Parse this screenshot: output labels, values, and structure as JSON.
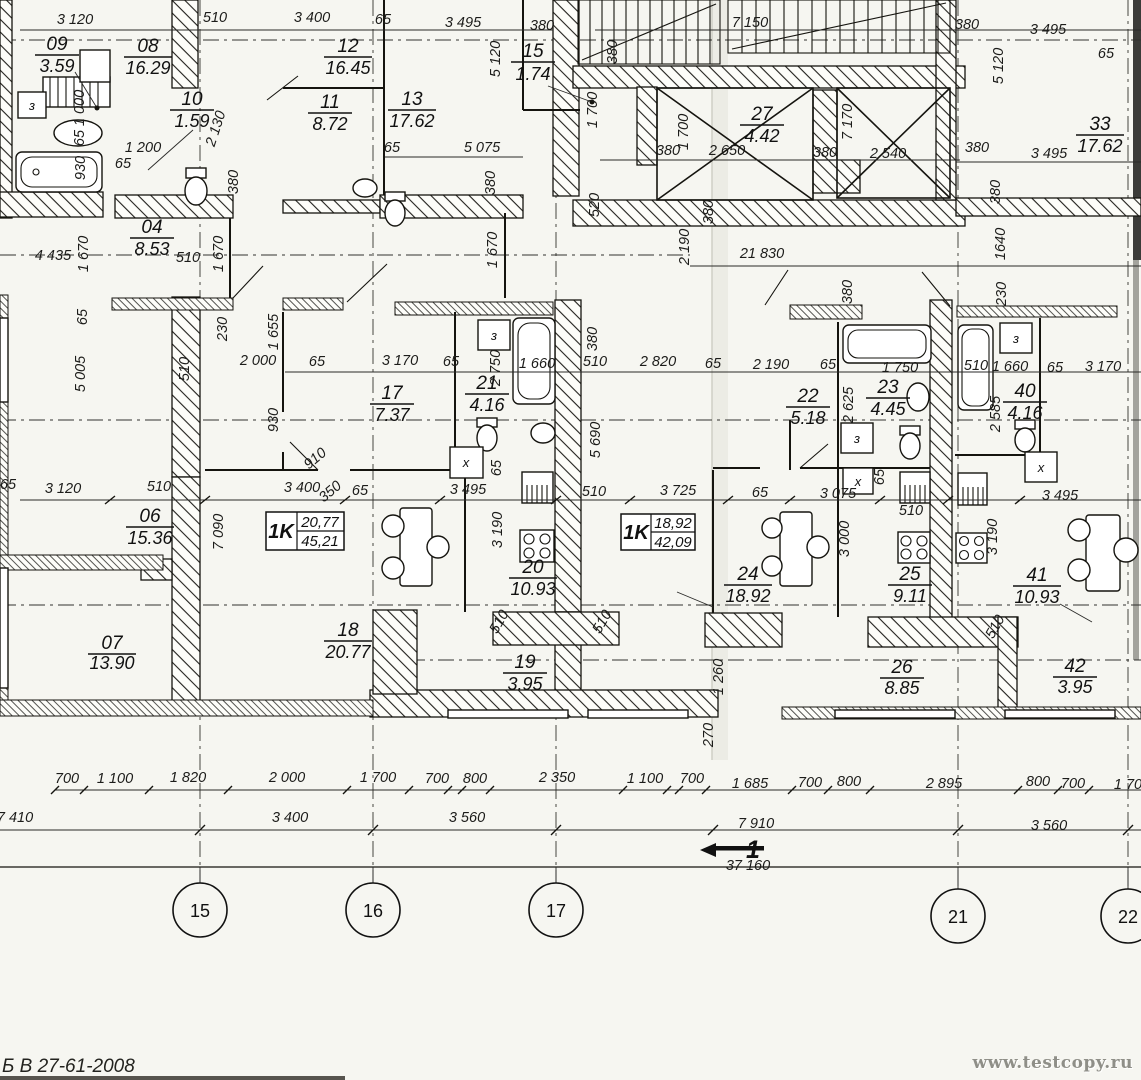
{
  "sheet": {
    "note": "Б В 27-61-2008",
    "watermark": "www.testcopy.ru"
  },
  "grid": [
    "15",
    "16",
    "17",
    "21",
    "22"
  ],
  "section": {
    "num": "1"
  },
  "apartments": [
    {
      "t": "1K",
      "a": "20,77",
      "b": "45,21"
    },
    {
      "t": "1K",
      "a": "18,92",
      "b": "42,09"
    }
  ],
  "boxes": {
    "vent": "з",
    "washer": "x"
  },
  "rooms": [
    {
      "n": "09",
      "a": "3.59"
    },
    {
      "n": "08",
      "a": "16.29"
    },
    {
      "n": "12",
      "a": "16.45"
    },
    {
      "n": "15",
      "a": "1.74"
    },
    {
      "n": "10",
      "a": "1.59"
    },
    {
      "n": "11",
      "a": "8.72"
    },
    {
      "n": "13",
      "a": "17.62"
    },
    {
      "n": "27",
      "a": "4.42"
    },
    {
      "n": "33",
      "a": "17.62"
    },
    {
      "n": "04",
      "a": "8.53"
    },
    {
      "n": "17",
      "a": "7.37"
    },
    {
      "n": "21",
      "a": "4.16"
    },
    {
      "n": "22",
      "a": "5.18"
    },
    {
      "n": "23",
      "a": "4.45"
    },
    {
      "n": "40",
      "a": "4.16"
    },
    {
      "n": "06",
      "a": "15.36"
    },
    {
      "n": "20",
      "a": "10.93"
    },
    {
      "n": "24",
      "a": "18.92"
    },
    {
      "n": "25",
      "a": "9.11"
    },
    {
      "n": "41",
      "a": "10.93"
    },
    {
      "n": "07",
      "a": "13.90"
    },
    {
      "n": "18",
      "a": "20.77"
    },
    {
      "n": "19",
      "a": "3.95"
    },
    {
      "n": "26",
      "a": "8.85"
    },
    {
      "n": "42",
      "a": "3.95"
    }
  ],
  "dims": [
    "3 120",
    "510",
    "3 400",
    "65",
    "3 495",
    "380",
    "7 150",
    "380",
    "3 495",
    "65",
    "5 120",
    "380",
    "1 700",
    "1 700",
    "380",
    "2 650",
    "380",
    "2 540",
    "7 170",
    "5 120",
    "380",
    "3 495",
    "380",
    "520",
    "380",
    "1640",
    "230",
    "2 190",
    "21 830",
    "380",
    "4 435",
    "1 670",
    "510",
    "1 670",
    "65",
    "5 005",
    "230",
    "1 655",
    "2 000",
    "65",
    "930",
    "910",
    "510",
    "350",
    "3 170",
    "65",
    "2 750",
    "1 660",
    "380",
    "510",
    "2 820",
    "65",
    "2 190",
    "65",
    "2 625",
    "1 750",
    "510",
    "1 660",
    "65",
    "3 170",
    "2 585",
    "5 690",
    "3 120",
    "510",
    "3 400",
    "65",
    "3 495",
    "65",
    "510",
    "3 725",
    "65",
    "3 075",
    "65",
    "510",
    "3 495",
    "7 090",
    "3 190",
    "3 000",
    "3 190",
    "1 260",
    "510",
    "510",
    "510",
    "270",
    "700",
    "1 100",
    "1 820",
    "2 000",
    "1 700",
    "700",
    "800",
    "2 350",
    "1 100",
    "700",
    "1 685",
    "700",
    "800",
    "2 895",
    "800",
    "700",
    "1 70",
    "7 410",
    "3 400",
    "3 560",
    "7 910",
    "3 560",
    "37 160",
    "65",
    "1 000",
    "65",
    "930",
    "1 200",
    "65",
    "2 130",
    "380",
    "65",
    "5 075",
    "380",
    "1 670"
  ]
}
